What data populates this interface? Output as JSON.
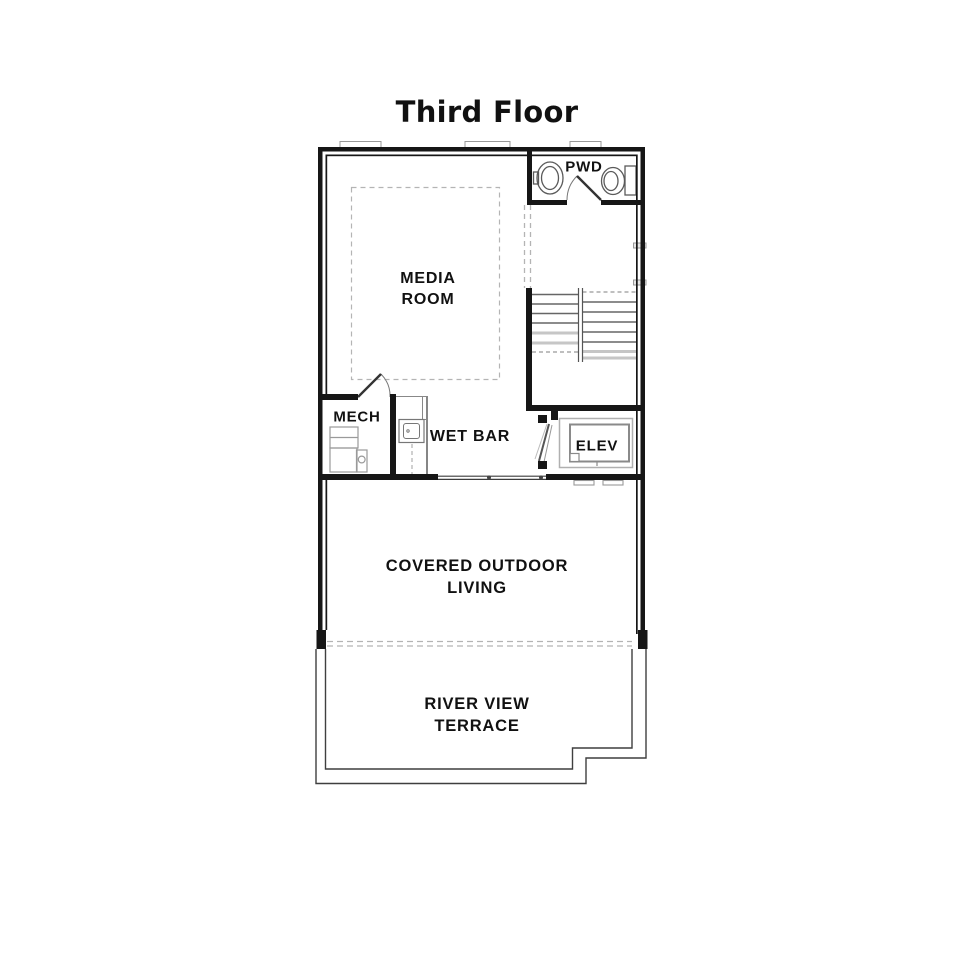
{
  "title": "Third Floor",
  "plan": {
    "rooms": {
      "pwd": {
        "label": "PWD"
      },
      "media": {
        "line1": "MEDIA",
        "line2": "ROOM"
      },
      "mech": {
        "label": "MECH"
      },
      "wet_bar": {
        "label": "WET BAR"
      },
      "elevator": {
        "label": "ELEV"
      },
      "covered_outdoor": {
        "line1": "COVERED OUTDOOR",
        "line2": "LIVING"
      },
      "terrace": {
        "line1": "RIVER VIEW",
        "line2": "TERRACE"
      }
    },
    "fixtures": [
      "pwd-sink-icon",
      "pwd-toilet-icon",
      "pwd-door-swing-icon",
      "stairs-icon",
      "mech-door-swing-icon",
      "mech-equipment-icon",
      "wetbar-counter-sink-icon",
      "elevator-car-icon",
      "elevator-door-icon",
      "sliding-door-icon",
      "terrace-outline",
      "roof-dashed-line"
    ],
    "colors": {
      "background": "#ffffff",
      "wall": "#161616",
      "text": "#111111",
      "dashed": "#b4b4b4",
      "fixture": "#8a8a8a",
      "tread_dark": "#666666",
      "tread_light": "#c6c6c6",
      "terrace_line": "#3f3f3f"
    }
  }
}
